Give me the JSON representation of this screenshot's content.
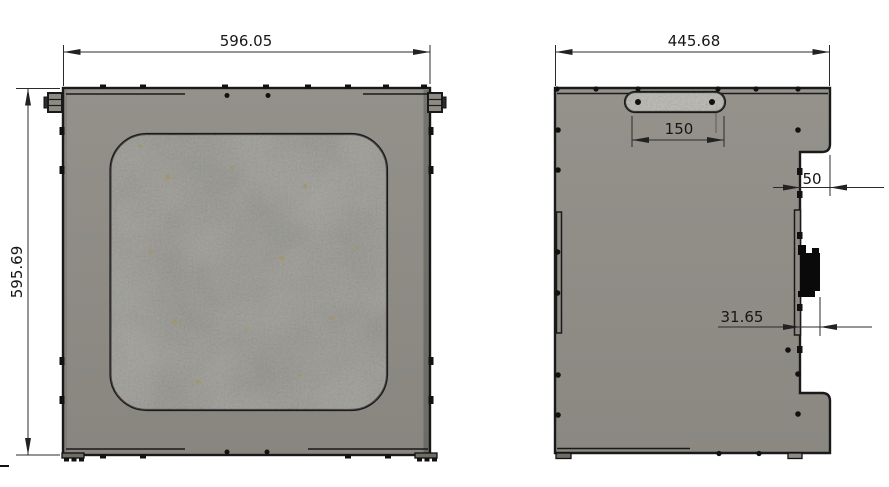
{
  "dims": {
    "front_width": "596.05",
    "front_height": "595.69",
    "side_width": "445.68",
    "handle_width": "150",
    "step_depth": "50",
    "connector_offset": "31.65"
  },
  "colors": {
    "background": "#ffffff",
    "outline": "#1a1a1a",
    "dimension_line": "#2b2b2b",
    "dimension_text": "#161616",
    "panel": "#8d8b84",
    "window": "#919089",
    "handle": "#b6b4ac",
    "connector": "#0a0a0a"
  }
}
